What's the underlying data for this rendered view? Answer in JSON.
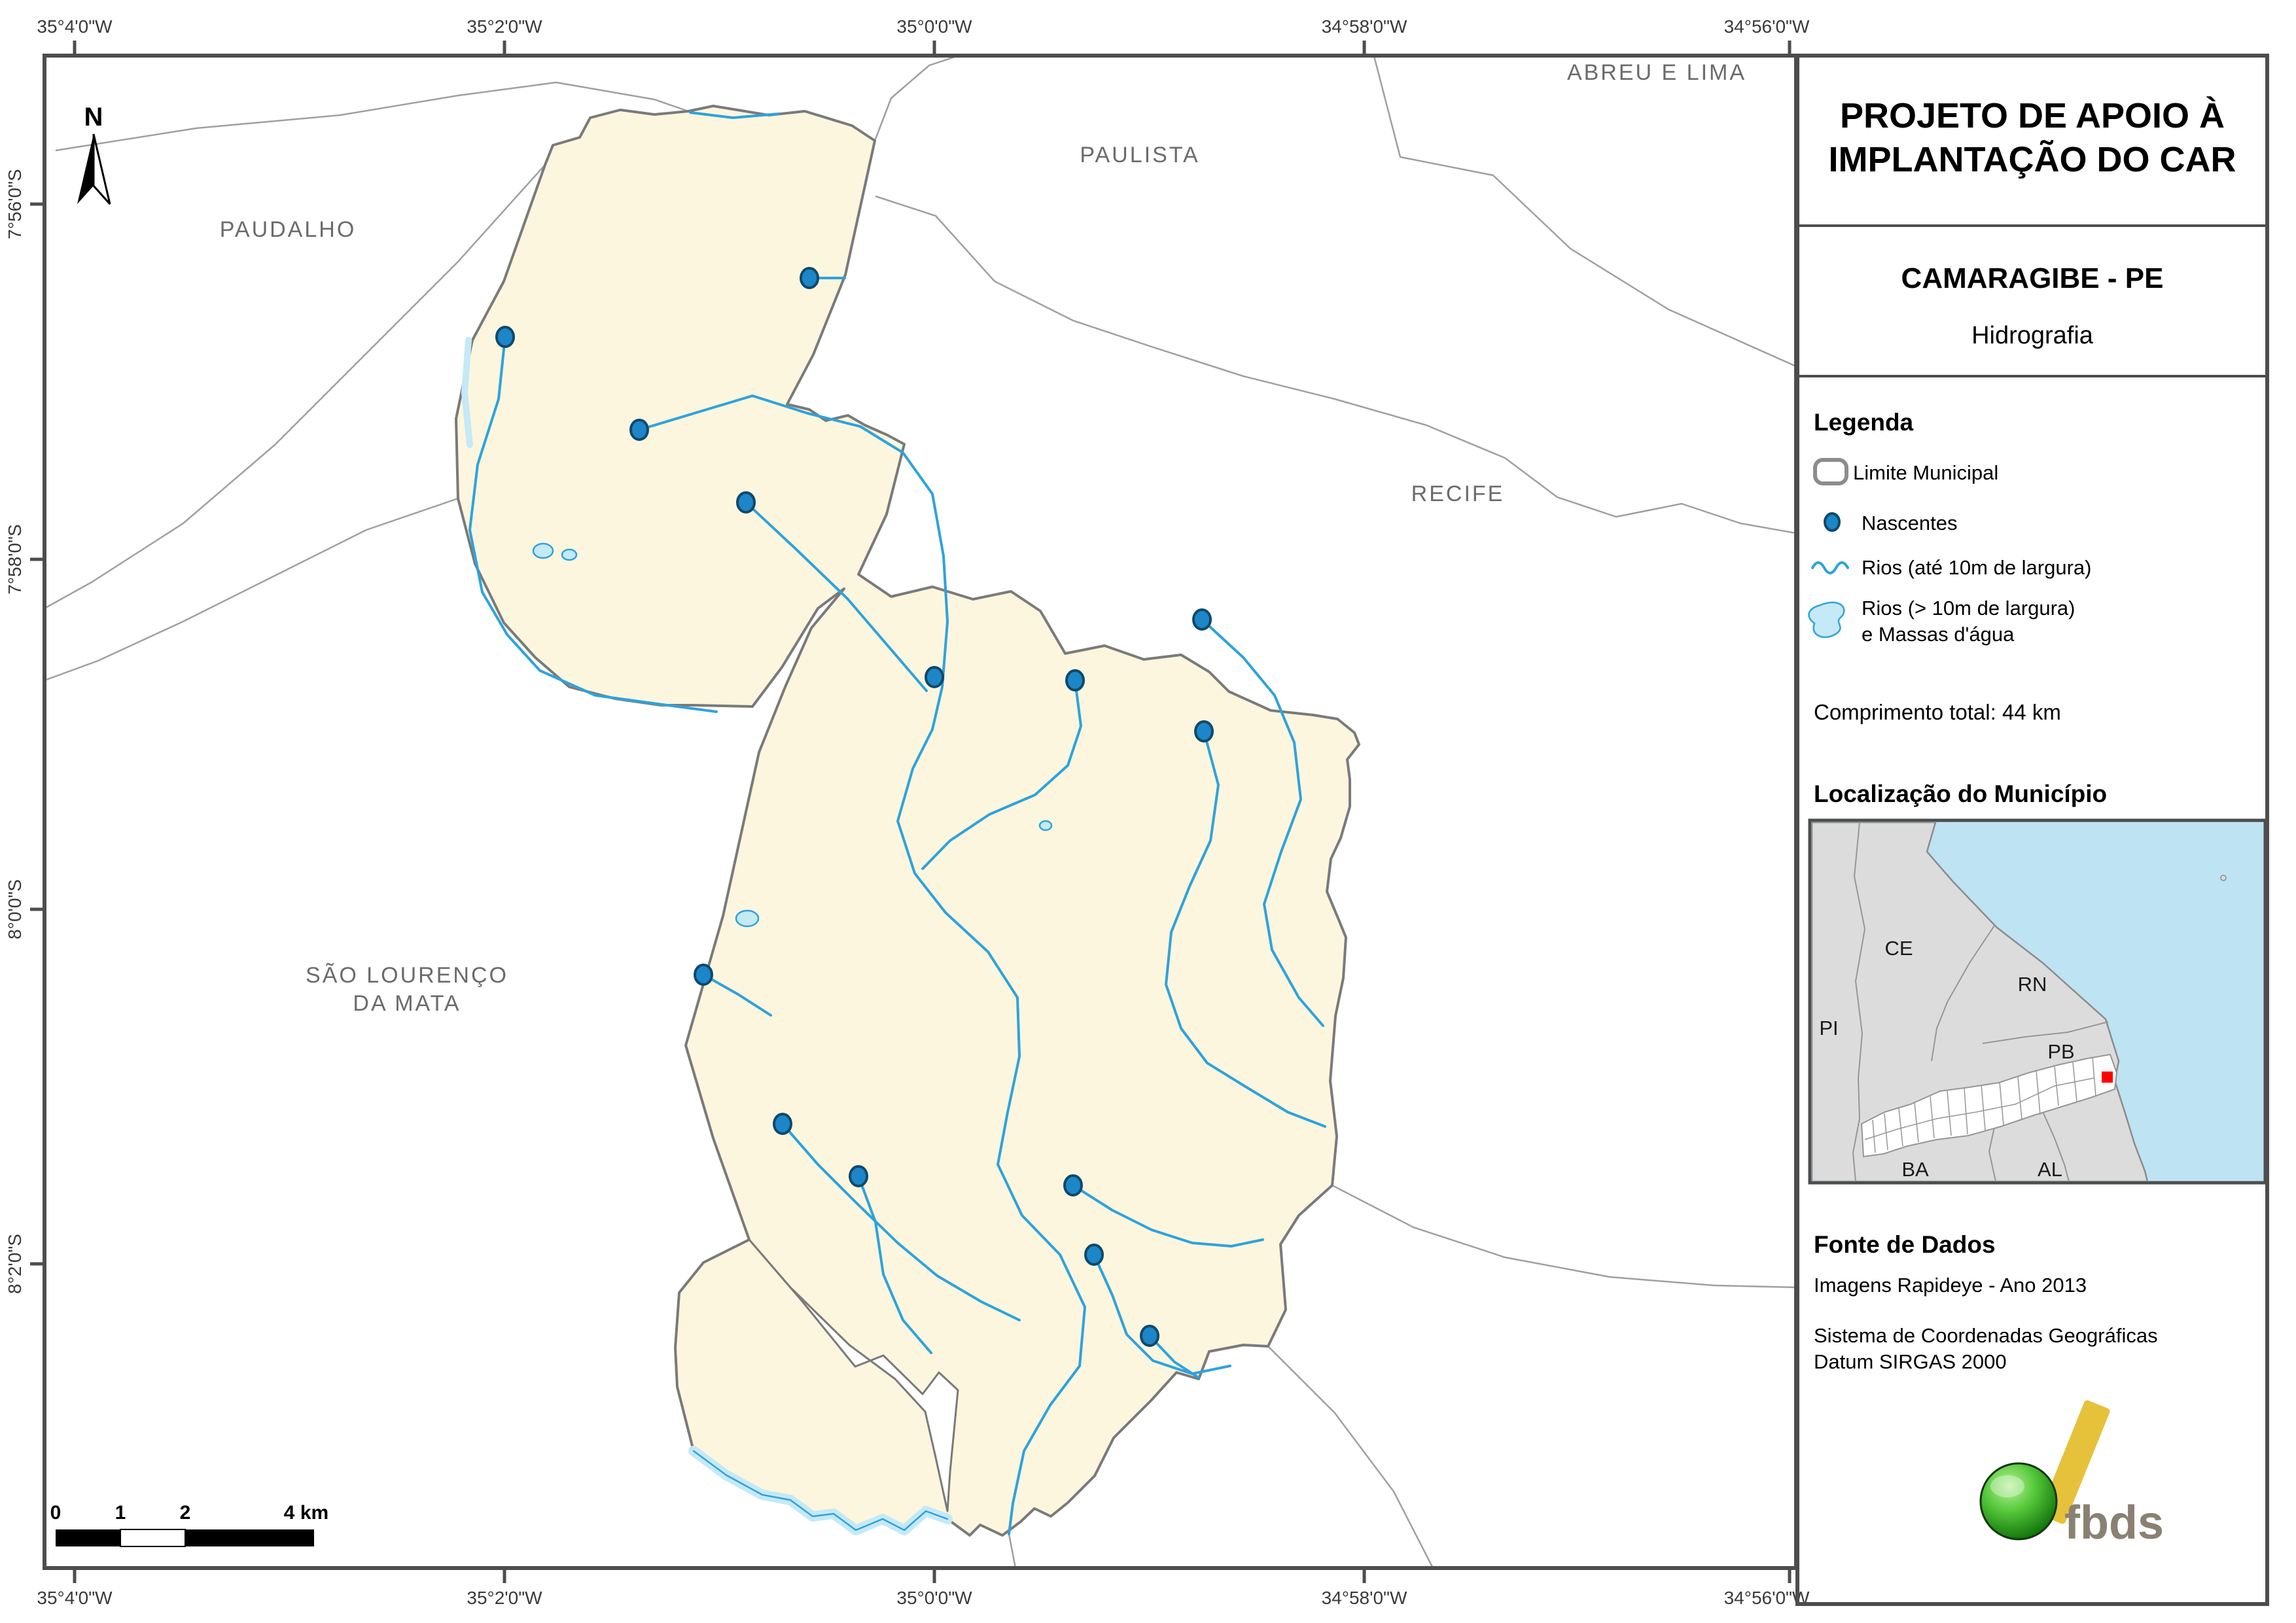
{
  "panel": {
    "title_line1": "PROJETO DE APOIO À",
    "title_line2": "IMPLANTAÇÃO DO CAR",
    "municipality": "CAMARAGIBE - PE",
    "theme": "Hidrografia",
    "legend": {
      "heading": "Legenda",
      "limite": "Limite Municipal",
      "nascentes": "Nascentes",
      "rios_small": "Rios (até 10m de largura)",
      "rios_large_1": "Rios (> 10m de largura)",
      "rios_large_2": "e Massas d'água",
      "total": "Comprimento total:  44 km"
    },
    "location": {
      "heading": "Localização do Município",
      "states": {
        "ce": "CE",
        "rn": "RN",
        "pi": "PI",
        "pb": "PB",
        "ba": "BA",
        "al": "AL"
      }
    },
    "source": {
      "heading": "Fonte de Dados",
      "imagery": "Imagens Rapideye - Ano 2013",
      "crs_line1": "Sistema de Coordenadas Geográficas",
      "crs_line2": "Datum SIRGAS 2000"
    },
    "logo_text": "fbds"
  },
  "map": {
    "north_label": "N",
    "neighbors": {
      "paudalho": "PAUDALHO",
      "paulista": "PAULISTA",
      "abreu": "ABREU E LIMA",
      "recife": "RECIFE",
      "slm1": "SÃO LOURENÇO",
      "slm2": "DA MATA"
    },
    "scalebar": {
      "k0": "0",
      "k1": "1",
      "k2": "2",
      "k4": "4 km"
    },
    "axis_top": [
      "35°4'0\"W",
      "35°2'0\"W",
      "35°0'0\"W",
      "34°58'0\"W",
      "34°56'0\"W"
    ],
    "axis_bottom": [
      "35°4'0\"W",
      "35°2'0\"W",
      "35°0'0\"W",
      "34°58'0\"W",
      "34°56'0\"W"
    ],
    "axis_left": [
      "7°56'0\"S",
      "7°58'0\"S",
      "8°0'0\"S",
      "8°2'0\"S"
    ]
  },
  "colors": {
    "municipality_fill": "#fdf6de",
    "municipality_border": "#7a7a7a",
    "river": "#2da3dc",
    "water_mass": "#c5e9f7",
    "nascente": "#1d86c8",
    "inset_sea": "#bee3f2",
    "inset_land": "#dcdcdc",
    "locator_marker": "#ff0000",
    "frame": "#4d4d4d",
    "logo_green": "#2fa812",
    "logo_yellow": "#e6c23b"
  }
}
